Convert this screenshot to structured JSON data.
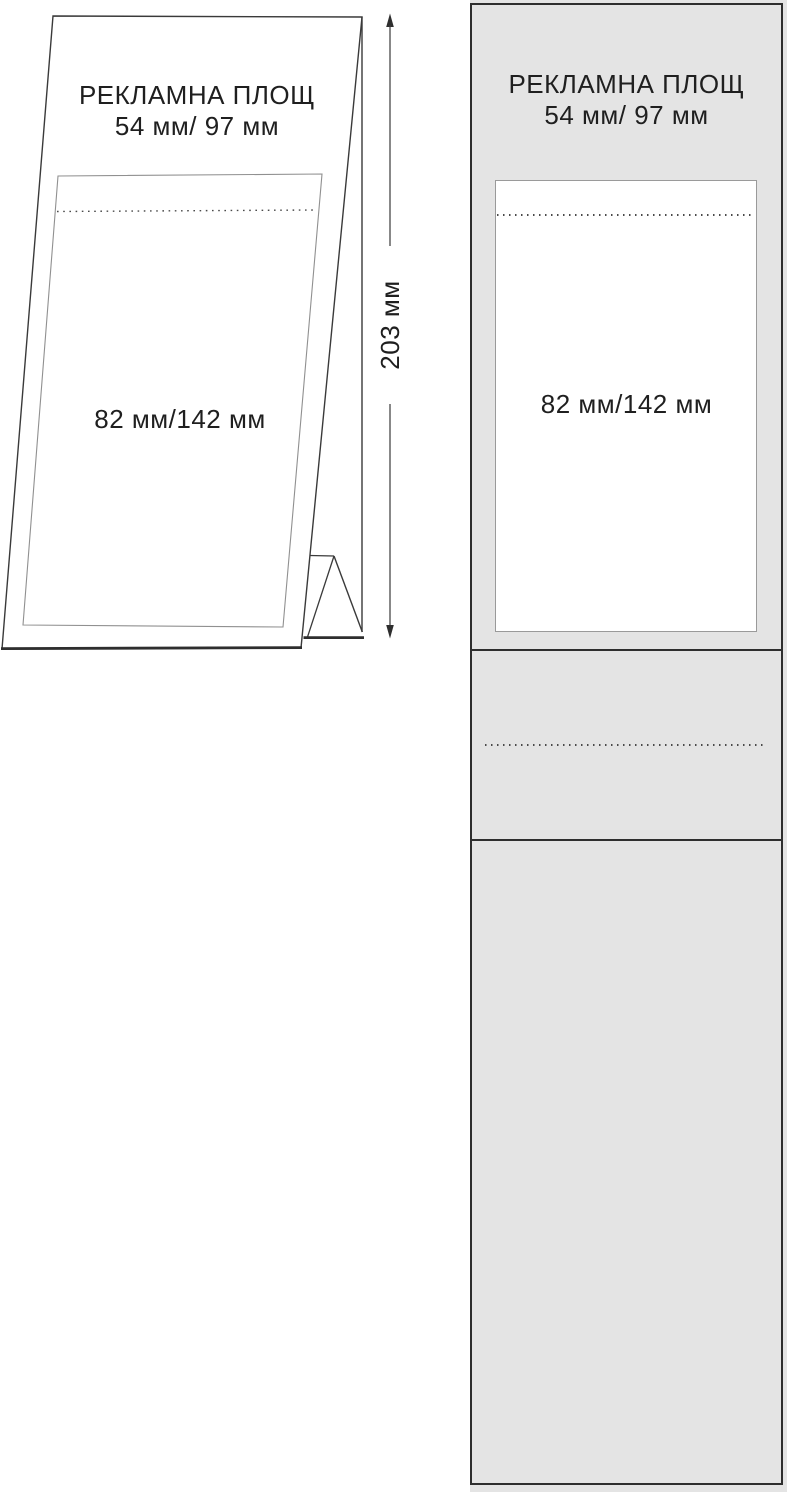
{
  "perspective_view": {
    "title": "РЕКЛАМНА ПЛОЩ",
    "ad_area_size": "54 мм/ 97 мм",
    "insert_area_size": "82 мм/142 мм",
    "total_height": "203 мм"
  },
  "flat_template": {
    "title": "РЕКЛАМНА ПЛОЩ",
    "ad_area_size": "54 мм/ 97 мм",
    "insert_area_size": "82 мм/142 мм"
  },
  "colors": {
    "panel_fill": "#e4e4e4",
    "outline_dark": "#2e2e2e",
    "outline_light": "#9a9a9a",
    "text": "#1f1f1f"
  }
}
